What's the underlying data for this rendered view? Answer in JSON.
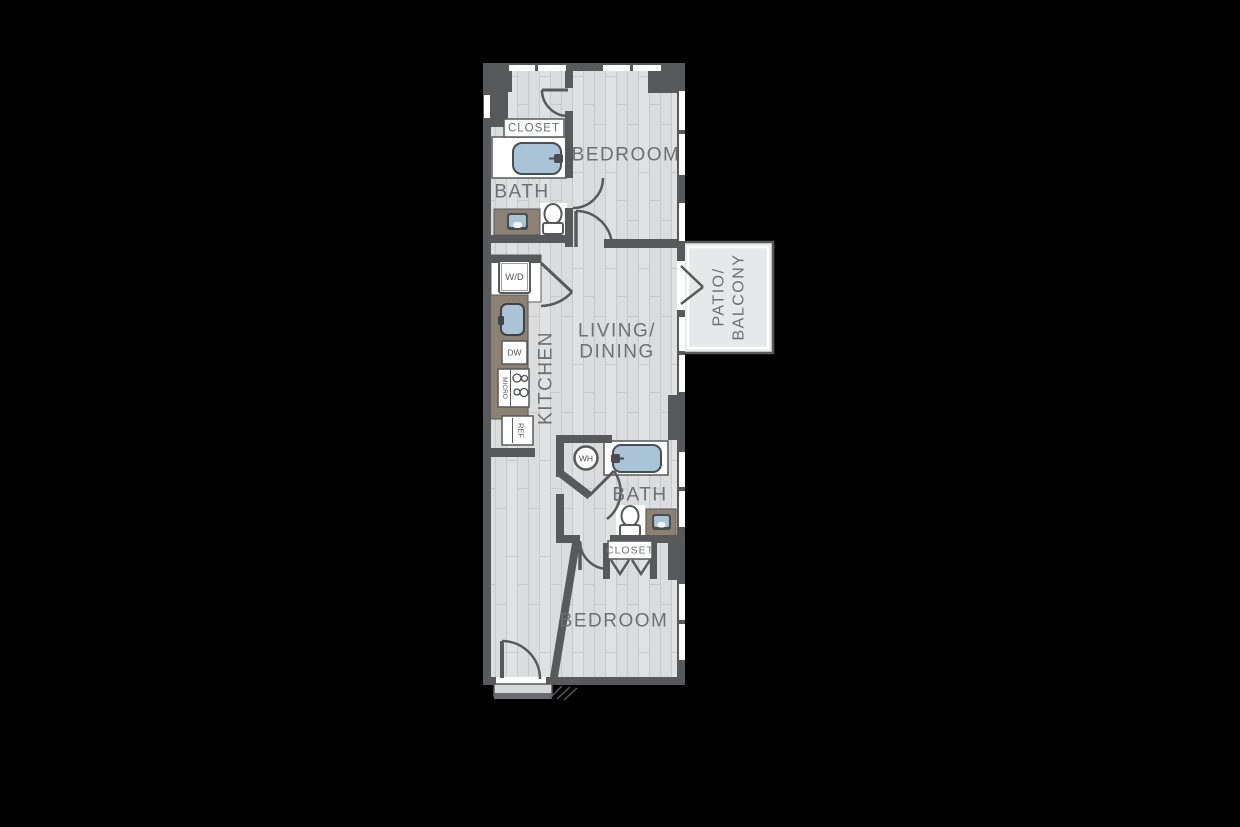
{
  "colors": {
    "background": "#000000",
    "wall": "#58595B",
    "floor": "#DBDCDE",
    "floor_line": "#C8C9CC",
    "fixture_blue": "#A9C3D7",
    "counter_tan": "#8C8273",
    "patio_floor": "#E7E8EA",
    "fixture_white": "#FFFFFF",
    "label_text": "#6E6F72"
  },
  "rooms": {
    "closet_top": "CLOSET",
    "bedroom_top": "BEDROOM",
    "bath_top": "BATH",
    "kitchen": "KITCHEN",
    "living_line1": "LIVING/",
    "living_line2": "DINING",
    "patio_line1": "PATIO/",
    "patio_line2": "BALCONY",
    "bath_bottom": "BATH",
    "closet_bottom": "CLOSET",
    "bedroom_bottom": "BEDROOM"
  },
  "appliances": {
    "washer_dryer": "W/D",
    "dishwasher": "DW",
    "microwave_range": "MICRO",
    "refrigerator": "REF",
    "water_heater": "WH"
  }
}
